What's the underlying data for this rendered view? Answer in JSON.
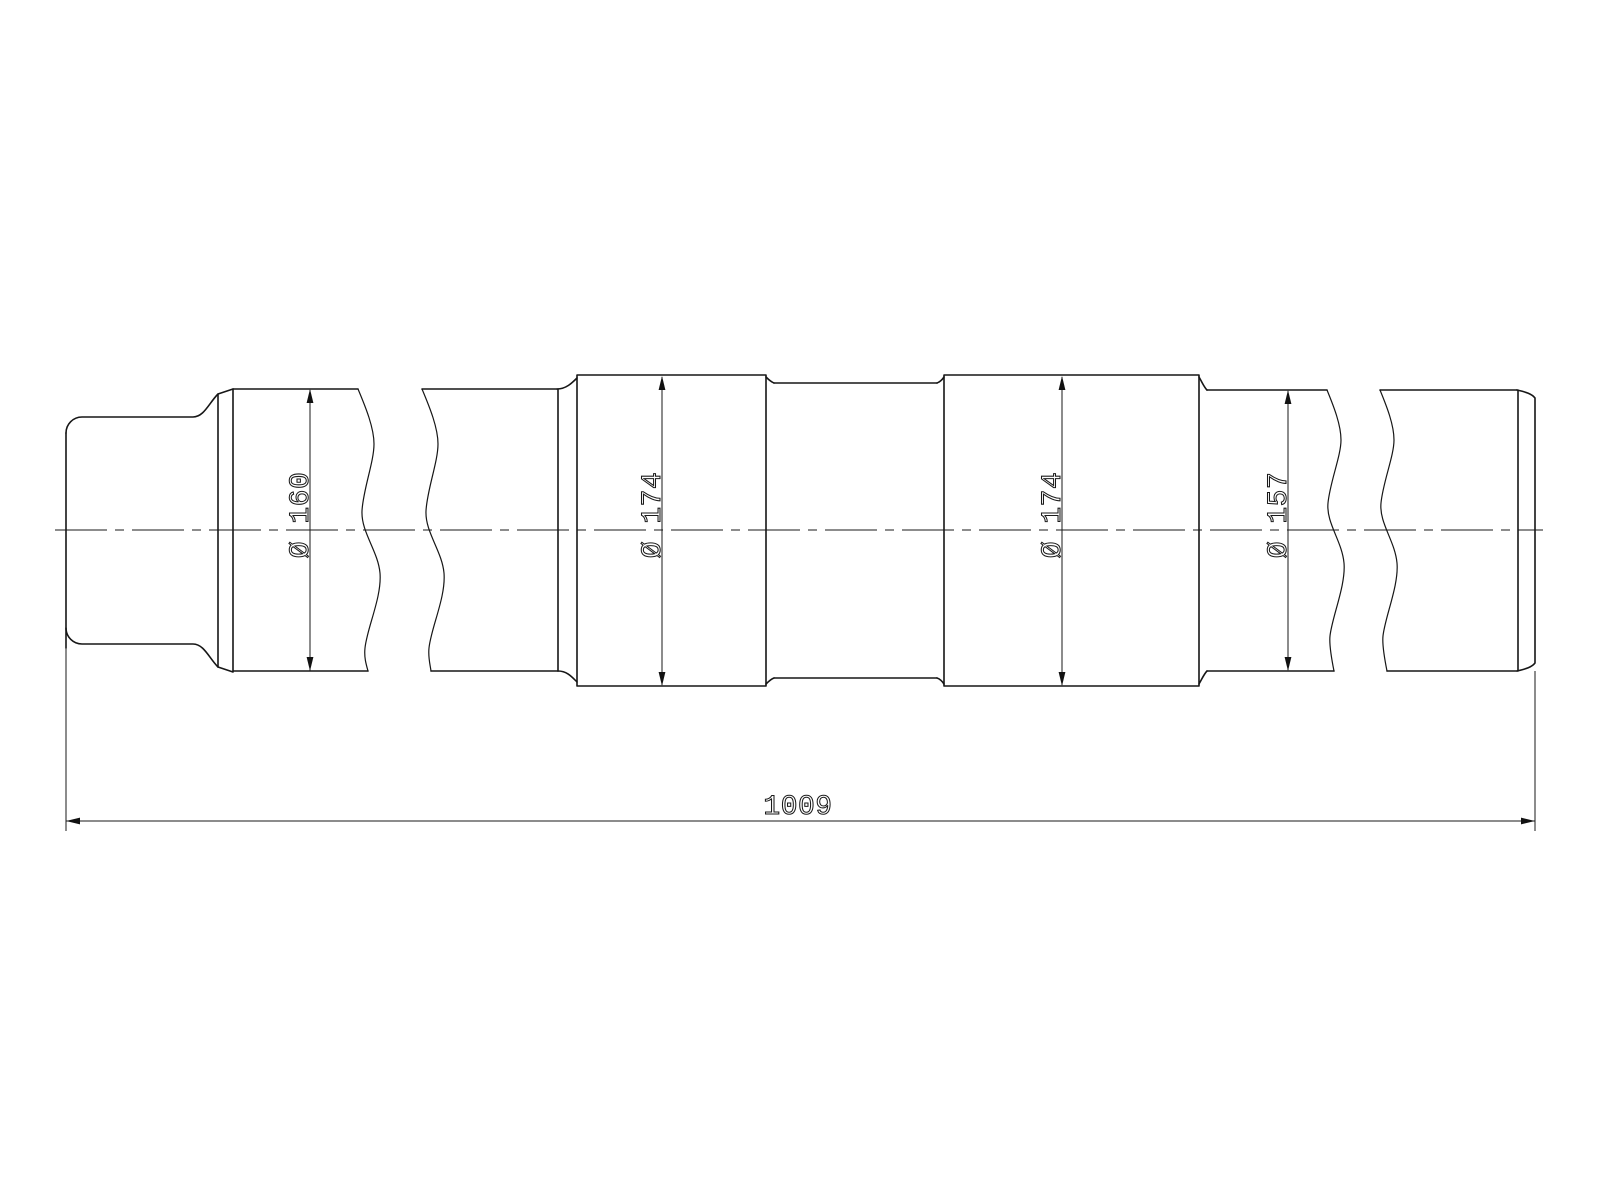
{
  "drawing": {
    "kind": "engineering-drawing",
    "subject": "stepped shaft, side view with break lines",
    "colors": {
      "background": "#ffffff",
      "line": "#161616"
    },
    "dimensions": {
      "left_section_diameter": {
        "label": "Ø 160",
        "symbol": "Ø",
        "value": 160
      },
      "first_seat_diameter": {
        "label": "Ø 174",
        "symbol": "Ø",
        "value": 174
      },
      "second_seat_diameter": {
        "label": "Ø 174",
        "symbol": "Ø",
        "value": 174
      },
      "right_section_diameter": {
        "label": "Ø 157",
        "symbol": "Ø",
        "value": 157
      },
      "overall_length": {
        "label": "1009",
        "value": 1009
      }
    }
  }
}
